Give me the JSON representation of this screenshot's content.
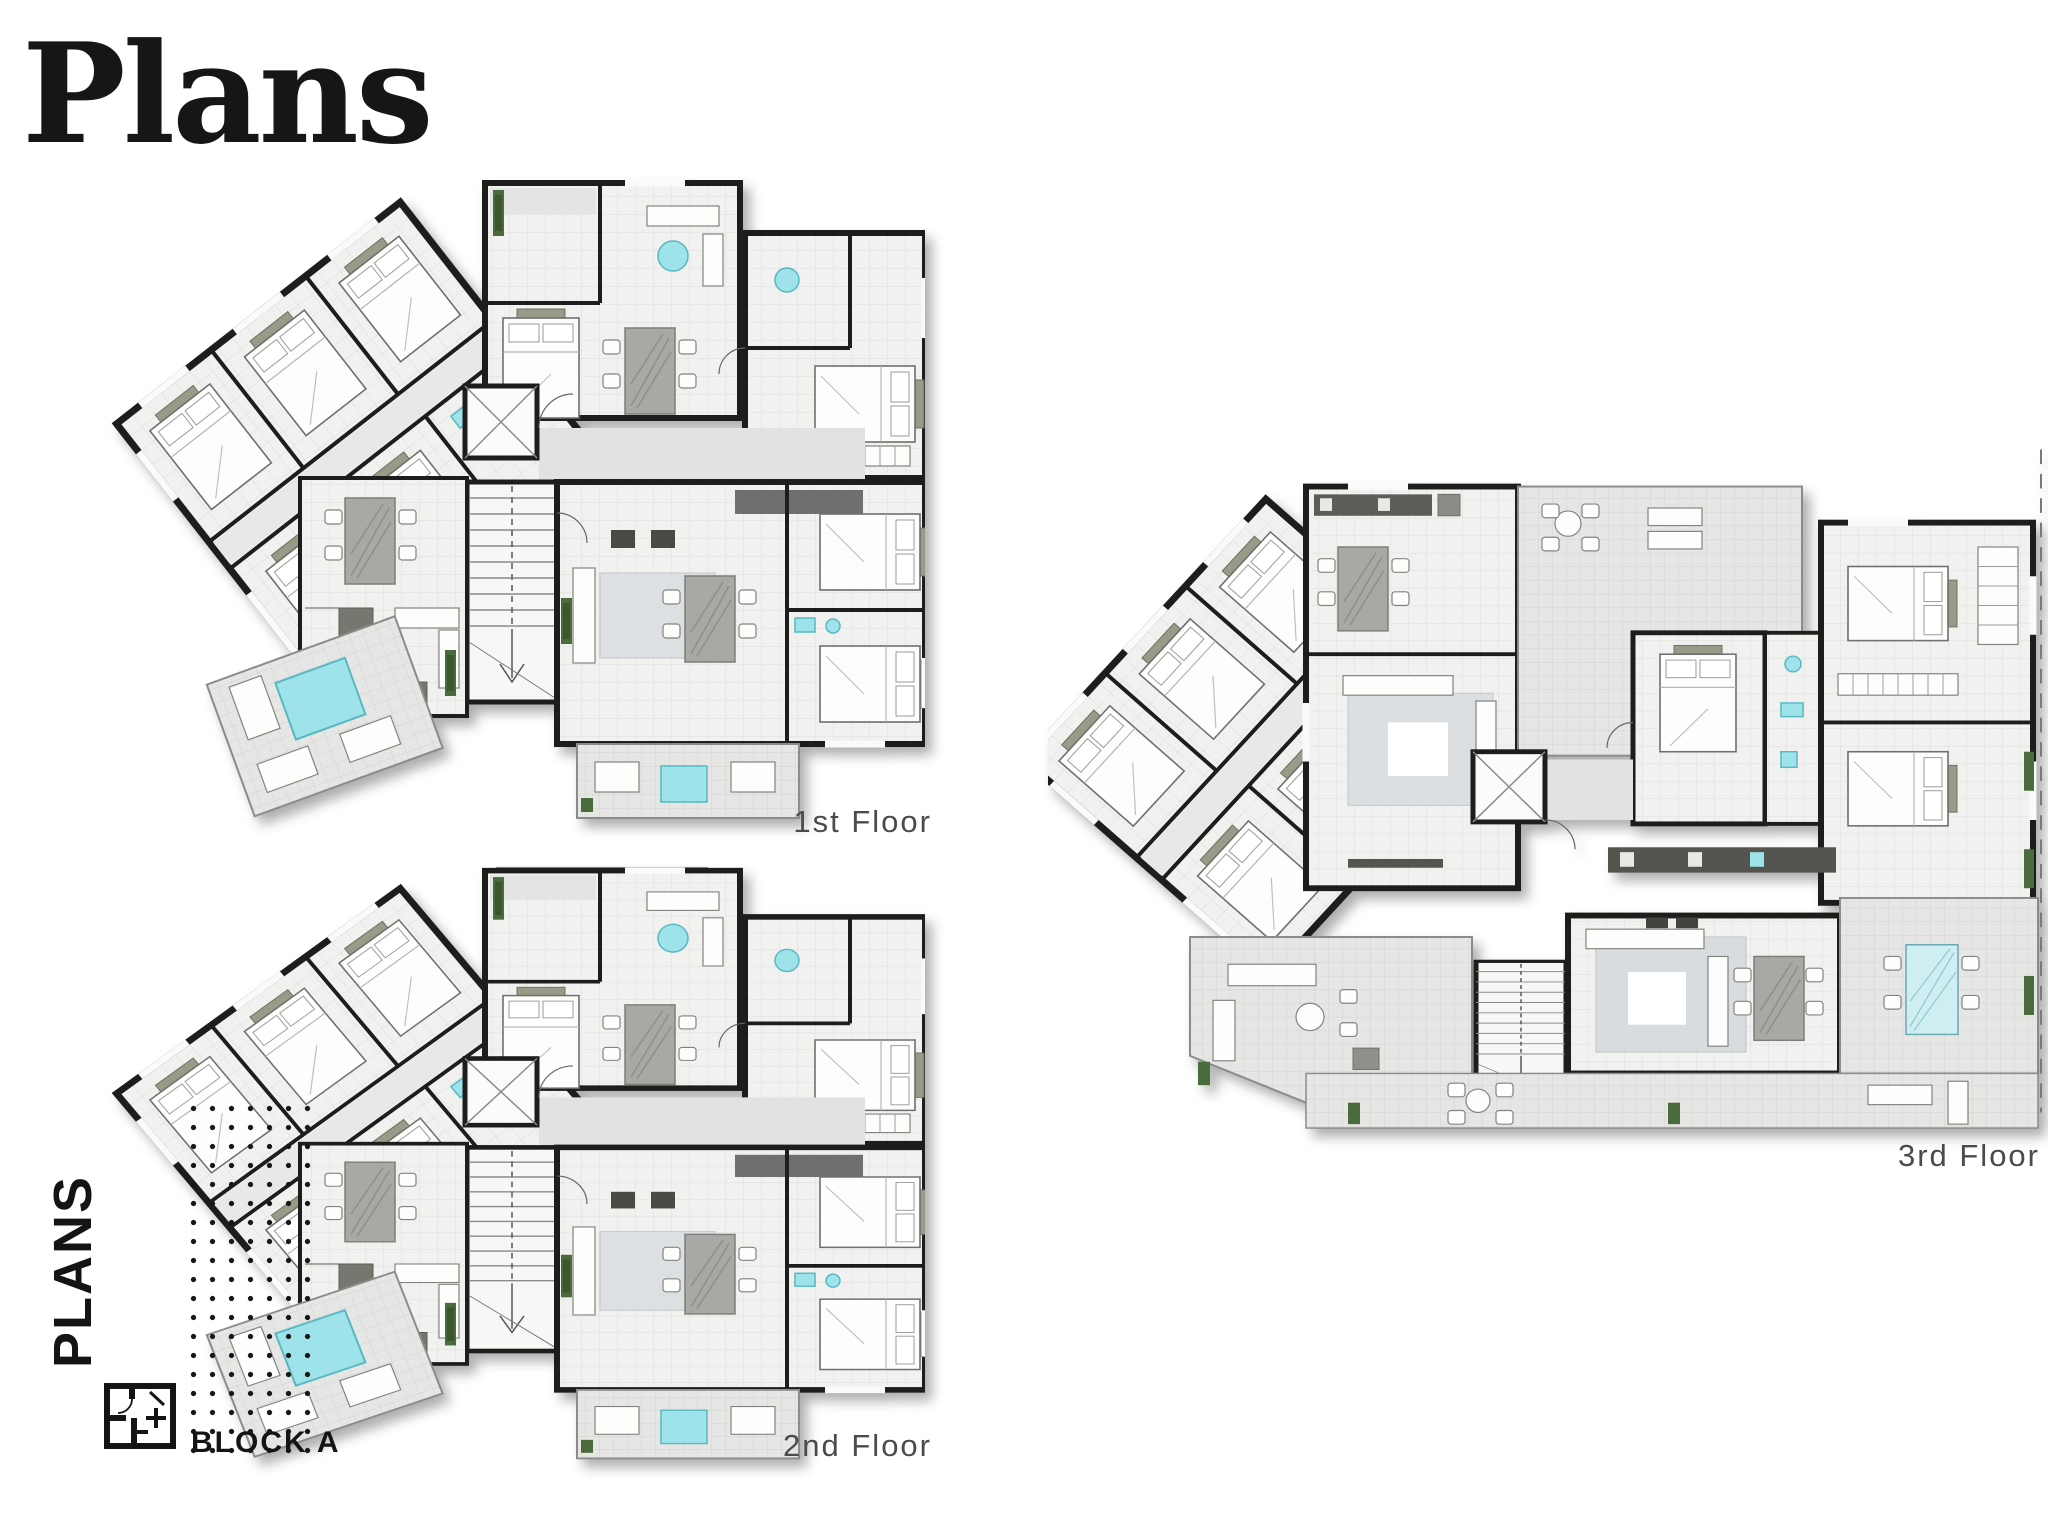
{
  "page": {
    "title": "Plans",
    "background": "#ffffff"
  },
  "floors": [
    {
      "label": "1st Floor"
    },
    {
      "label": "2nd Floor"
    },
    {
      "label": "3rd Floor"
    }
  ],
  "branding": {
    "vertical_label": "PLANS",
    "block_label": "BLOCK A",
    "block_icon": "floor-plan-icon"
  },
  "palette": {
    "wall": "#1d1d1b",
    "floor_fill": "#f1f1ef",
    "floor_grid": "#dddddb",
    "terrace_fill": "#e6e6e4",
    "terrace_grid": "#d3d3d1",
    "corridor": "#e2e2e0",
    "water_accent": "#9fe3ea",
    "glass_accent": "#cfeef2",
    "plant_green": "#4a6c3c",
    "furniture_gray": "#a8a8a4",
    "counter_dark": "#55554f",
    "label_text": "#4b4b4b",
    "title_text": "#171615"
  }
}
